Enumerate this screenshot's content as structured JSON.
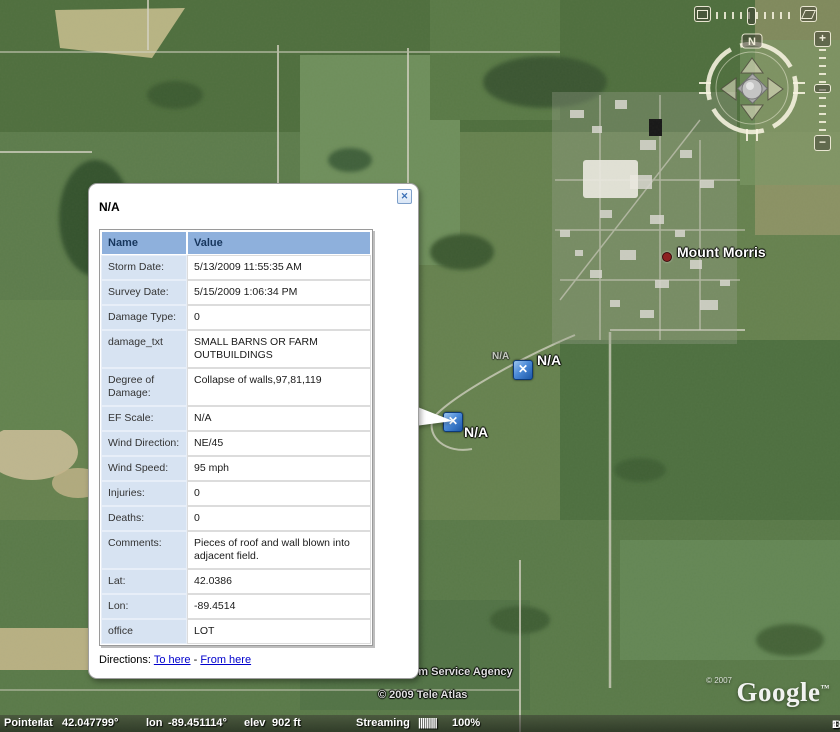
{
  "colors": {
    "placemark_blue": "#2a6fc9",
    "table_header_blue": "#8EB0DC",
    "table_label_blue": "#D7E3F2",
    "link_blue": "#0000CC",
    "town_dot_red": "#8d2121"
  },
  "map": {
    "town_label": "Mount Morris",
    "placemark_upper_label": "N/A",
    "placemark_lower_label": "N/A",
    "placemark_faint_label": "N/A",
    "attribution_fragment": "rm Service Agency",
    "attribution_tele_atlas": "© 2009 Tele Atlas",
    "google_copyright": "© 2007",
    "google_logo": "Google",
    "google_tm": "™"
  },
  "popup": {
    "title": "N/A",
    "close_label": "✕",
    "table": {
      "headers": [
        "Name",
        "Value"
      ],
      "rows": [
        [
          "Storm Date:",
          "5/13/2009 11:55:35 AM"
        ],
        [
          "Survey Date:",
          "5/15/2009 1:06:34 PM"
        ],
        [
          "Damage Type:",
          "0"
        ],
        [
          "damage_txt",
          "SMALL BARNS OR FARM OUTBUILDINGS"
        ],
        [
          "Degree of Damage:",
          "Collapse of walls,97,81,119"
        ],
        [
          "EF Scale:",
          "N/A"
        ],
        [
          "Wind Direction:",
          "NE/45"
        ],
        [
          "Wind Speed:",
          "95 mph"
        ],
        [
          "Injuries:",
          "0"
        ],
        [
          "Deaths:",
          "0"
        ],
        [
          "Comments:",
          "Pieces of roof and wall blown into adjacent field."
        ],
        [
          "Lat:",
          "42.0386"
        ],
        [
          "Lon:",
          "-89.4514"
        ],
        [
          "office",
          "LOT"
        ]
      ]
    },
    "directions": {
      "label": "Directions:",
      "to_here": "To here",
      "separator": "-",
      "from_here": "From here"
    }
  },
  "navigation": {
    "north": "N",
    "zoom_in": "+",
    "zoom_out": "−"
  },
  "status_bar": {
    "pointer": "Pointer",
    "lat_label": "lat",
    "lat_value": "42.047799°",
    "lon_label": "lon",
    "lon_value": "-89.451114°",
    "elev_label": "elev",
    "elev_value": "902 ft",
    "streaming_label": "Streaming",
    "streaming_bars": "|||||||||",
    "streaming_pct": "100%",
    "eye_alt_label": "Eye alt",
    "eye_alt_value": "18631 ft"
  }
}
